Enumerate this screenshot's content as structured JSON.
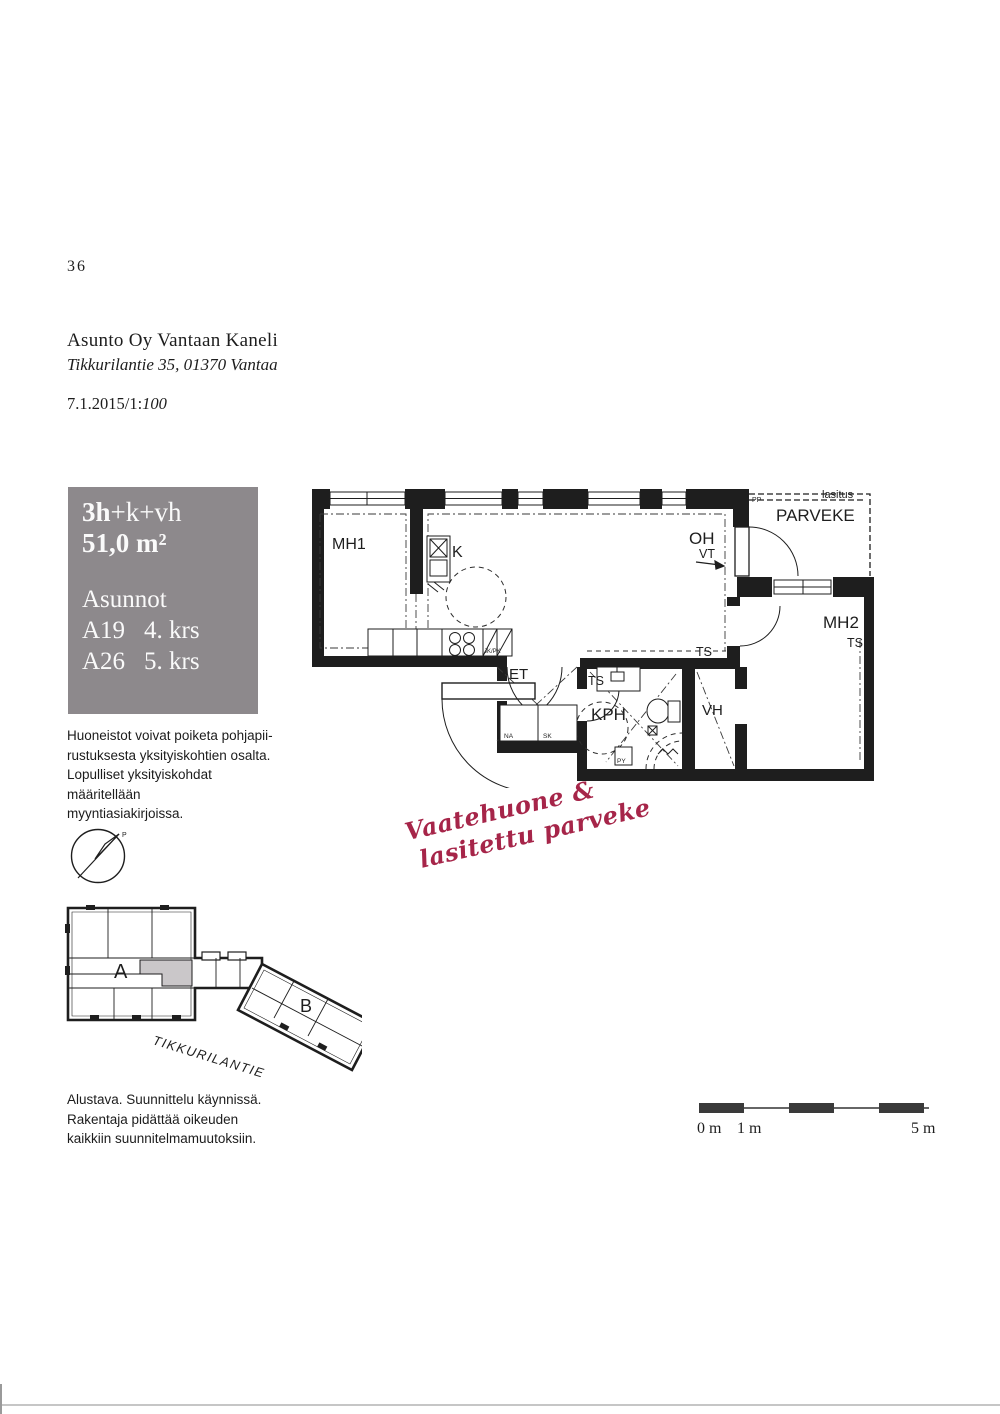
{
  "page_number": "36",
  "header": {
    "title": "Asunto Oy Vantaan Kaneli",
    "address": "Tikkurilantie 35, 01370 Vantaa",
    "date_prefix": "7.1.2015/1:",
    "scale": "100"
  },
  "info_box": {
    "type_bold": "3h",
    "type_rest": "+k+vh",
    "area": "51,0 m²",
    "list_title": "Asunnot",
    "apartments": [
      {
        "id": "A19",
        "floor": "4. krs"
      },
      {
        "id": "A26",
        "floor": "5. krs"
      }
    ]
  },
  "note_top": {
    "line1": "Huoneistot voivat poiketa pohjapii-",
    "line2": "rustuksesta yksityiskohtien osalta.",
    "line3": "Lopulliset yksityiskohdat määritellään",
    "line4": "myyntiasiakirjoissa."
  },
  "floorplan": {
    "mh1": "MH1",
    "k": "K",
    "oh": "OH",
    "vt": "VT",
    "parveke": "PARVEKE",
    "lasitus": "lasitus",
    "pp": "PP",
    "mh2": "MH2",
    "et": "ET",
    "kph": "KPH",
    "vh": "VH",
    "ts": "TS",
    "na": "NA",
    "sk": "SK",
    "py": "PY",
    "jkpk": "JK/PK",
    "ppkkr": "PPK/KR"
  },
  "annotation": {
    "line1": "Vaatehuone &",
    "line2": "lasitettu parveke"
  },
  "site": {
    "building_a": "A",
    "building_b": "B",
    "street": "TIKKURILANTIE",
    "compass_north": "P"
  },
  "note_bottom": {
    "line1": "Alustava. Suunnittelu käynnissä.",
    "line2": "Rakentaja pidättää oikeuden",
    "line3": "kaikkiin suunnitelmamuutoksiin."
  },
  "scale_bar": {
    "m0": "0 m",
    "m1": "1 m",
    "m5": "5 m"
  },
  "colors": {
    "wall": "#1e1e1e",
    "info_box_bg": "#8d898c",
    "annotation_red": "#a62549",
    "site_highlight": "#cac7c9"
  }
}
